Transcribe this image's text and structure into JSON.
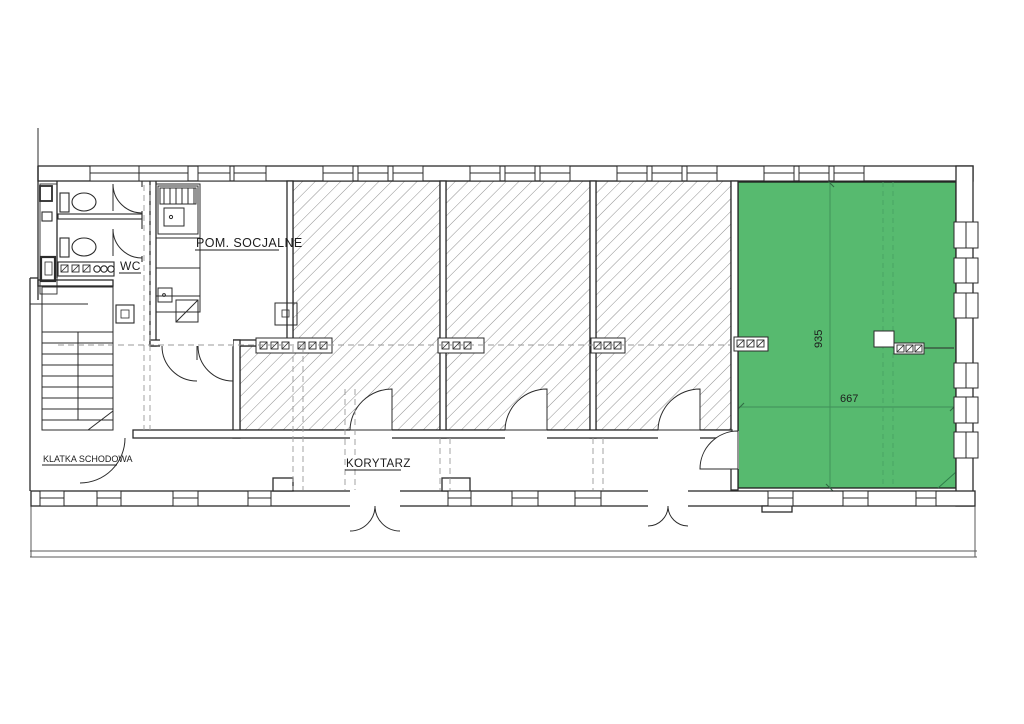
{
  "plan": {
    "rooms": {
      "social_room_label": "POM. SOCJALNE",
      "wc_label": "WC",
      "staircase_label": "KLATKA SCHODOWA",
      "corridor_label": "KORYTARZ"
    },
    "highlighted_room": {
      "width_dim": "667",
      "depth_dim": "935",
      "fill": "#57ba6f"
    },
    "colors": {
      "wall_line": "#2b2b2b",
      "hatch_line": "#8f8f8f",
      "dim_line": "#3f8f58",
      "dim_text": "#2f6b44"
    }
  }
}
